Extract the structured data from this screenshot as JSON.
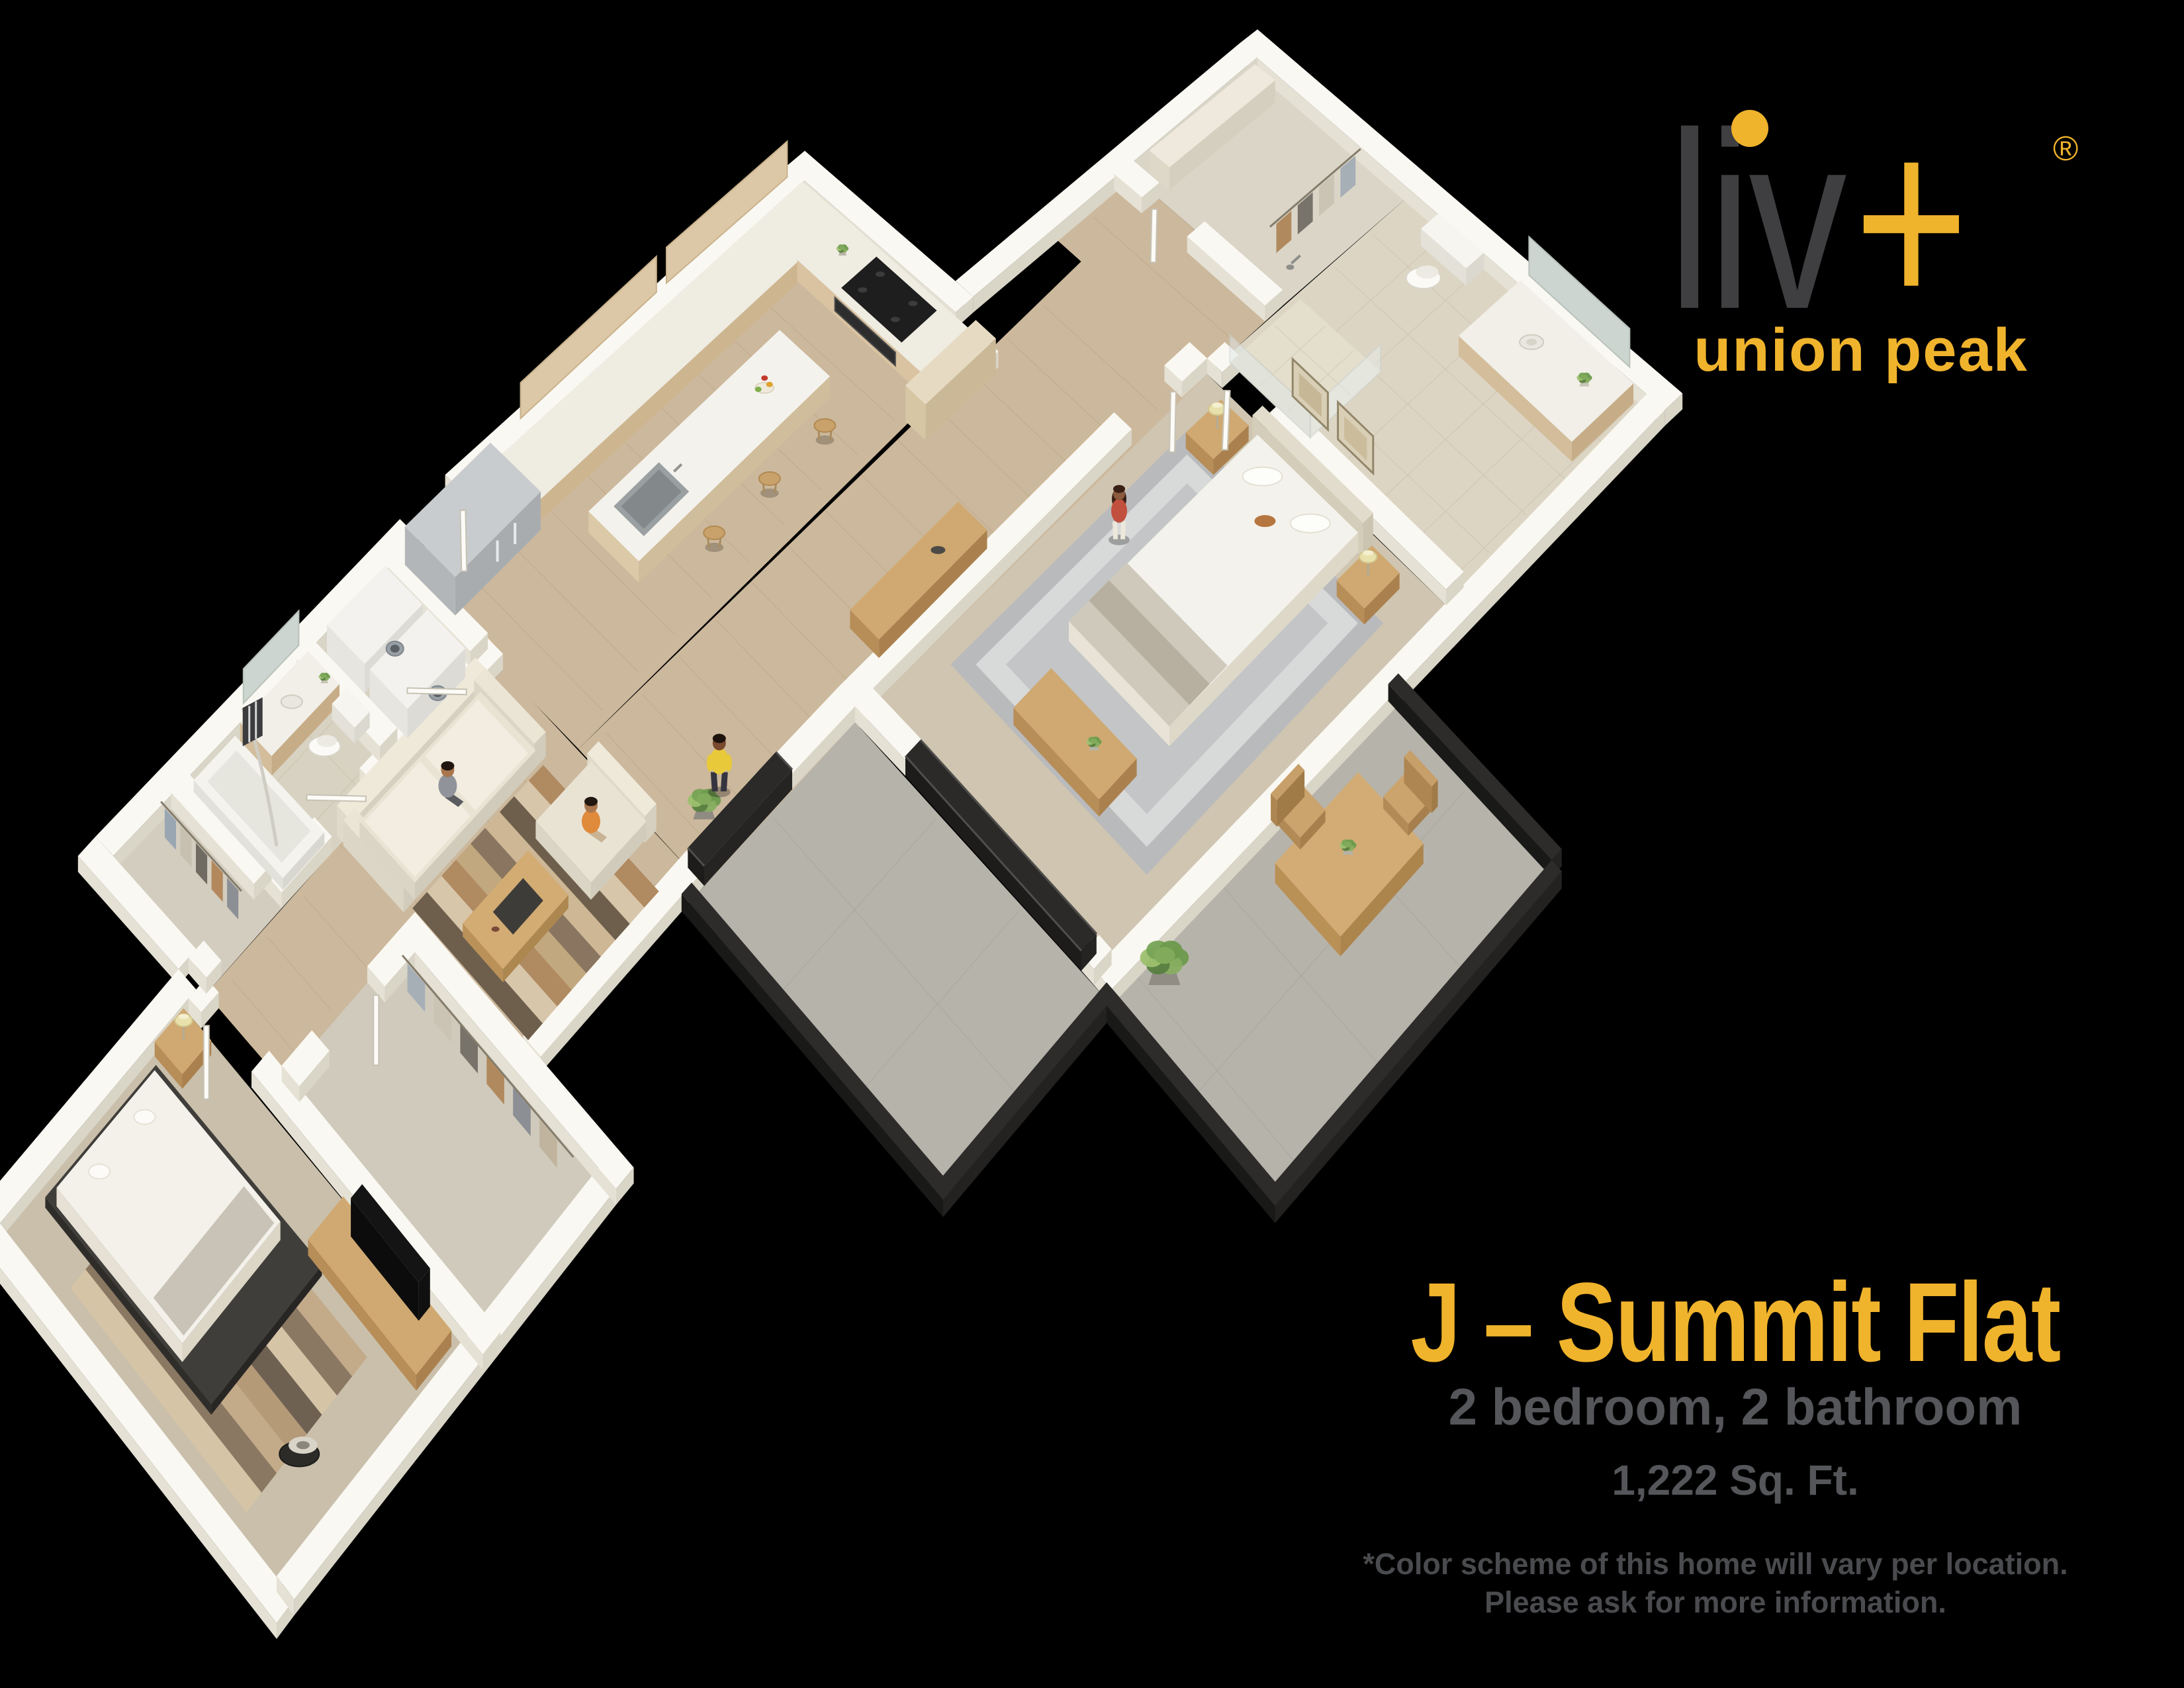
{
  "logo": {
    "brand": "liv",
    "plus": "+",
    "registered": "®",
    "subbrand": "union peak"
  },
  "plan": {
    "title": "J – Summit Flat",
    "subtitle": "2 bedroom, 2 bathroom",
    "area": "1,222 Sq. Ft.",
    "disclaimer_line1": "*Color scheme of this home will vary per location.",
    "disclaimer_line2": "Please ask for more information."
  },
  "colors": {
    "background": "#000000",
    "accent_gold": "#f0b32c",
    "brand_gray": "#3f3f41",
    "subtitle_gray": "#55565a",
    "disclaimer_gray": "#4a4b4e",
    "wall_white": "#faf8f2",
    "wood_floor": "#ccb89c",
    "carpet": "#cfc5b1",
    "concrete": "#b6b3ab"
  }
}
